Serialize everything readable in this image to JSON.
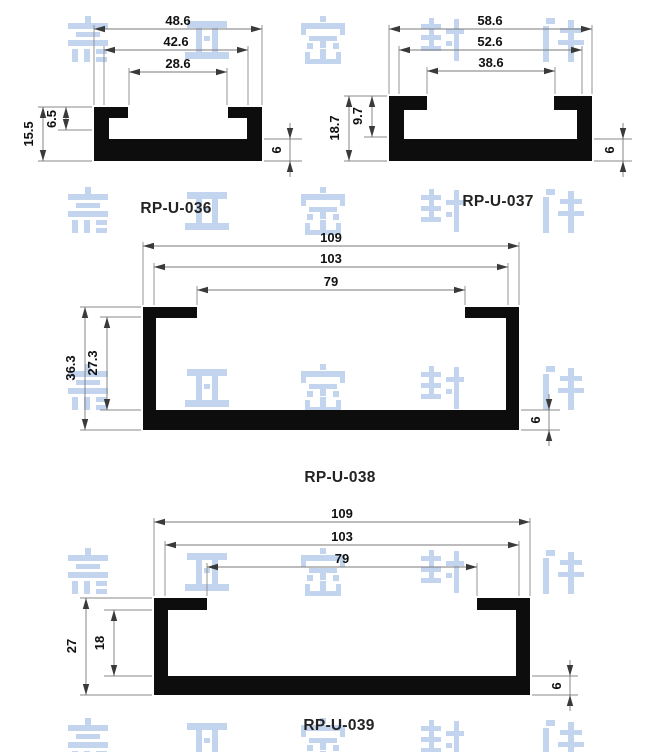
{
  "page": {
    "background": "#ffffff"
  },
  "watermark": {
    "text": "嘉亚密封件",
    "characters": [
      "嘉",
      "亚",
      "密",
      "封",
      "件"
    ],
    "color": "#c3d5ee"
  },
  "profiles": [
    {
      "label": "RP-U-036",
      "dims": {
        "outer_width": "48.6",
        "inner_width": "42.6",
        "opening_width": "28.6",
        "total_height": "15.5",
        "secondary_height": "6.5",
        "base_thickness": "6"
      }
    },
    {
      "label": "RP-U-037",
      "dims": {
        "outer_width": "58.6",
        "inner_width": "52.6",
        "opening_width": "38.6",
        "total_height": "18.7",
        "secondary_height": "9.7",
        "base_thickness": "6"
      }
    },
    {
      "label": "RP-U-038",
      "dims": {
        "outer_width": "109",
        "inner_width": "103",
        "opening_width": "79",
        "total_height": "36.3",
        "secondary_height": "27.3",
        "base_thickness": "6"
      }
    },
    {
      "label": "RP-U-039",
      "dims": {
        "outer_width": "109",
        "inner_width": "103",
        "opening_width": "79",
        "total_height": "27",
        "secondary_height": "18",
        "base_thickness": "6"
      }
    }
  ]
}
